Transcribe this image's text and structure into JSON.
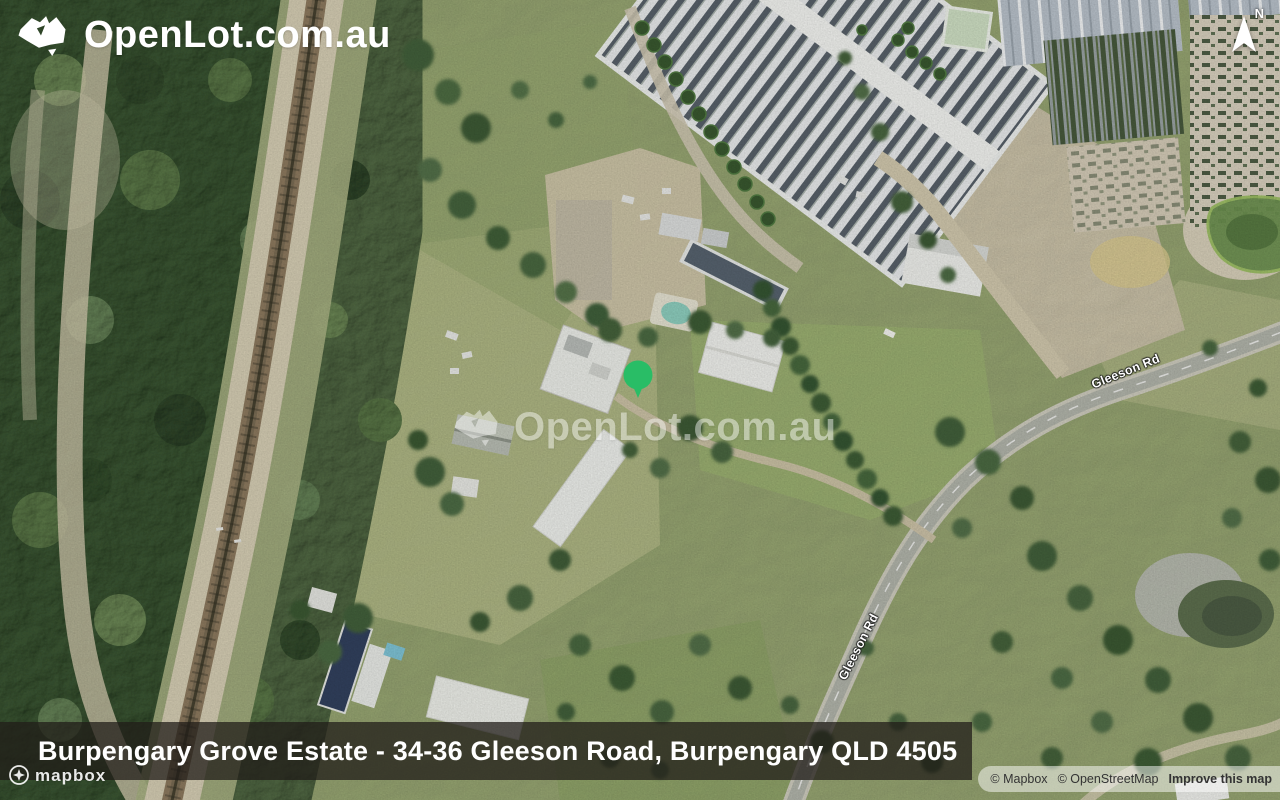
{
  "brand": {
    "logo_text": "OpenLot.com.au",
    "watermark_text": "OpenLot.com.au"
  },
  "compass": {
    "label": "N"
  },
  "map": {
    "road_labels": [
      "Gleeson Rd",
      "Gleeson Rd"
    ],
    "marker": {
      "shape": "green-circle-pin"
    }
  },
  "banner": {
    "title": "Burpengary Grove Estate - 34-36 Gleeson Road, Burpengary QLD 4505"
  },
  "footer": {
    "mapbox_wordmark": "mapbox",
    "attribution_mapbox": "© Mapbox",
    "attribution_osm": "© OpenStreetMap",
    "attribution_improve": "Improve this map"
  },
  "colors": {
    "marker_green": "#29bd66",
    "banner_bg": "rgba(33,29,24,0.74)",
    "logo_white": "#ffffff",
    "attribution_text": "#333333"
  }
}
